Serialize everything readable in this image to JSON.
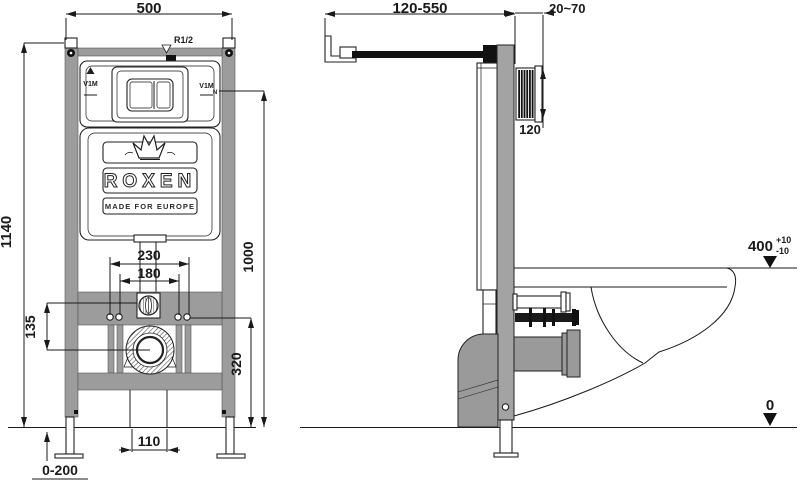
{
  "front_view": {
    "dims": {
      "width": "500",
      "height": "1140",
      "flush_span": "230",
      "bolt_span": "180",
      "offset": "135",
      "drain_height": "320",
      "axis_height": "1000",
      "outlet_width": "110",
      "leg_range": "0-200"
    },
    "labels": {
      "thread": "R1/2",
      "plate_left": "V1M",
      "plate_right": "V1M",
      "n_mark": "N"
    },
    "logo": {
      "brand": "ROXEN",
      "tagline": "MADE FOR EUROPE"
    }
  },
  "side_view": {
    "dims": {
      "depth_range": "120-550",
      "wall_range": "20~70",
      "shaft": "120"
    },
    "levels": {
      "seat": "400",
      "tol_plus": "+10",
      "tol_minus": "-10",
      "floor": "0"
    }
  },
  "colors": {
    "line": "#1a1a1a",
    "frame_gray": "#9c9c9c",
    "pipe_gray": "#9a9a9a"
  }
}
